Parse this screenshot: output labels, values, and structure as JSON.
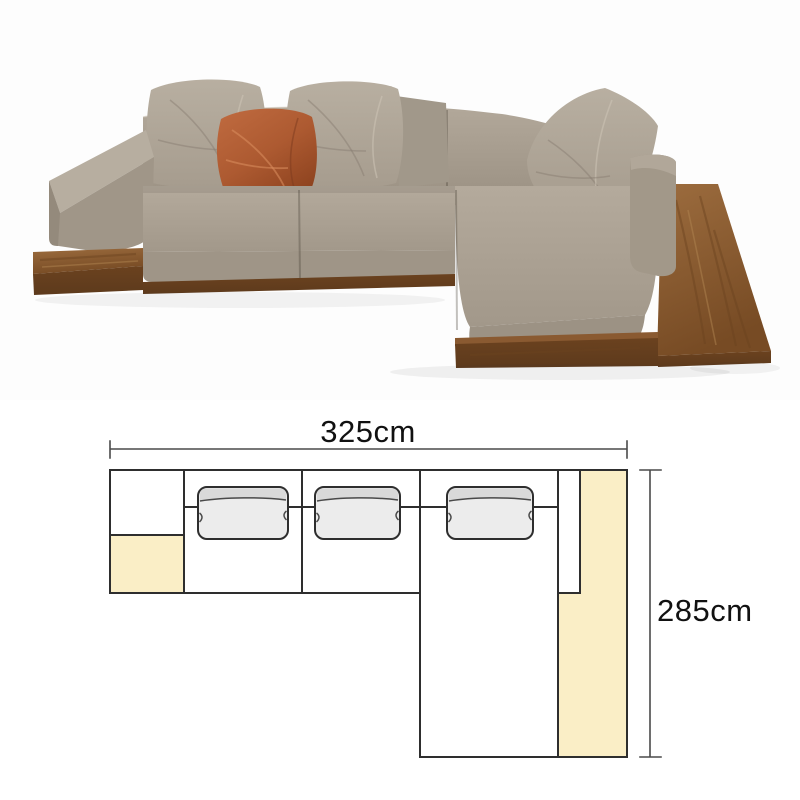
{
  "product_photo": {
    "description": "Modern L-shaped sectional sofa with taupe fabric cushions, one rust-orange accent pillow, on a walnut wood platform base with integrated side table",
    "colors": {
      "fabric_light": "#b8afa1",
      "fabric_mid": "#a69c8e",
      "fabric_dark": "#90877a",
      "accent_pillow": "#ad5a31",
      "wood_top": "#8f5f33",
      "wood_front": "#5d3a1c",
      "background": "#fdfdfd"
    }
  },
  "diagram": {
    "width_label": "325cm",
    "depth_label": "285cm",
    "width_cm": 325,
    "depth_cm": 285,
    "colors": {
      "highlight": "#faeec6",
      "cushion_fill": "#ececec",
      "cushion_band": "#d9d9d9",
      "line": "#2e2e2e",
      "dim_line": "#4a4a4a",
      "text": "#111111"
    }
  }
}
